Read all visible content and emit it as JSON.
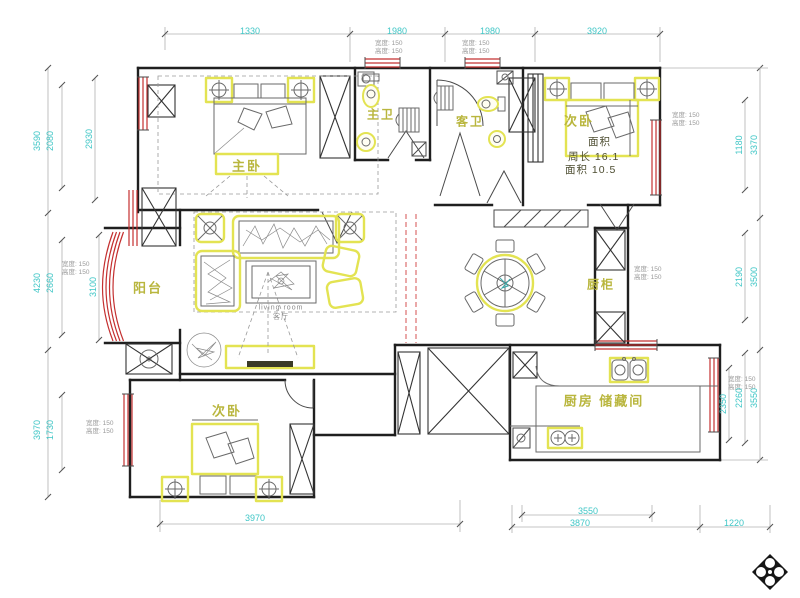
{
  "drawing": {
    "rooms": {
      "master_bedroom": "主卧",
      "master_bath": "主卫",
      "guest_bath": "客卫",
      "bedroom_top_right": "次卧",
      "balcony": "阳台",
      "cabinet": "厨柜",
      "kitchen_storage": "厨房 储藏间",
      "bedroom_bottom_left": "次卧"
    },
    "room_stats": {
      "area_tag": "面积",
      "perimeter": "周长  16.1",
      "area": "面积  10.5"
    },
    "living_note": {
      "line1": "living room",
      "line2": "客厅"
    },
    "window_note": {
      "line1": "宽度: 150",
      "line2": "高度: 150"
    },
    "dimensions": {
      "top": [
        "1330",
        "1980",
        "1980",
        "3920"
      ],
      "bottom_left": "3970",
      "bottom_right": [
        "3550",
        "3870",
        "1220"
      ],
      "left_outer": [
        "3590",
        "4230",
        "3970"
      ],
      "left_inner": [
        "2080",
        "2660",
        "1730"
      ],
      "left_rooms": [
        "2930",
        "3100"
      ],
      "right_outer": [
        "3370",
        "3500",
        "3550"
      ],
      "right_inner": [
        "1180",
        "2190",
        "2260"
      ],
      "right_window": "2350"
    },
    "colors": {
      "dimension_text": "#3fc6c6",
      "wall": "#1f1f1f",
      "window": "#c43030",
      "highlight": "#e3e352",
      "room_label": "#b9b63e"
    }
  }
}
